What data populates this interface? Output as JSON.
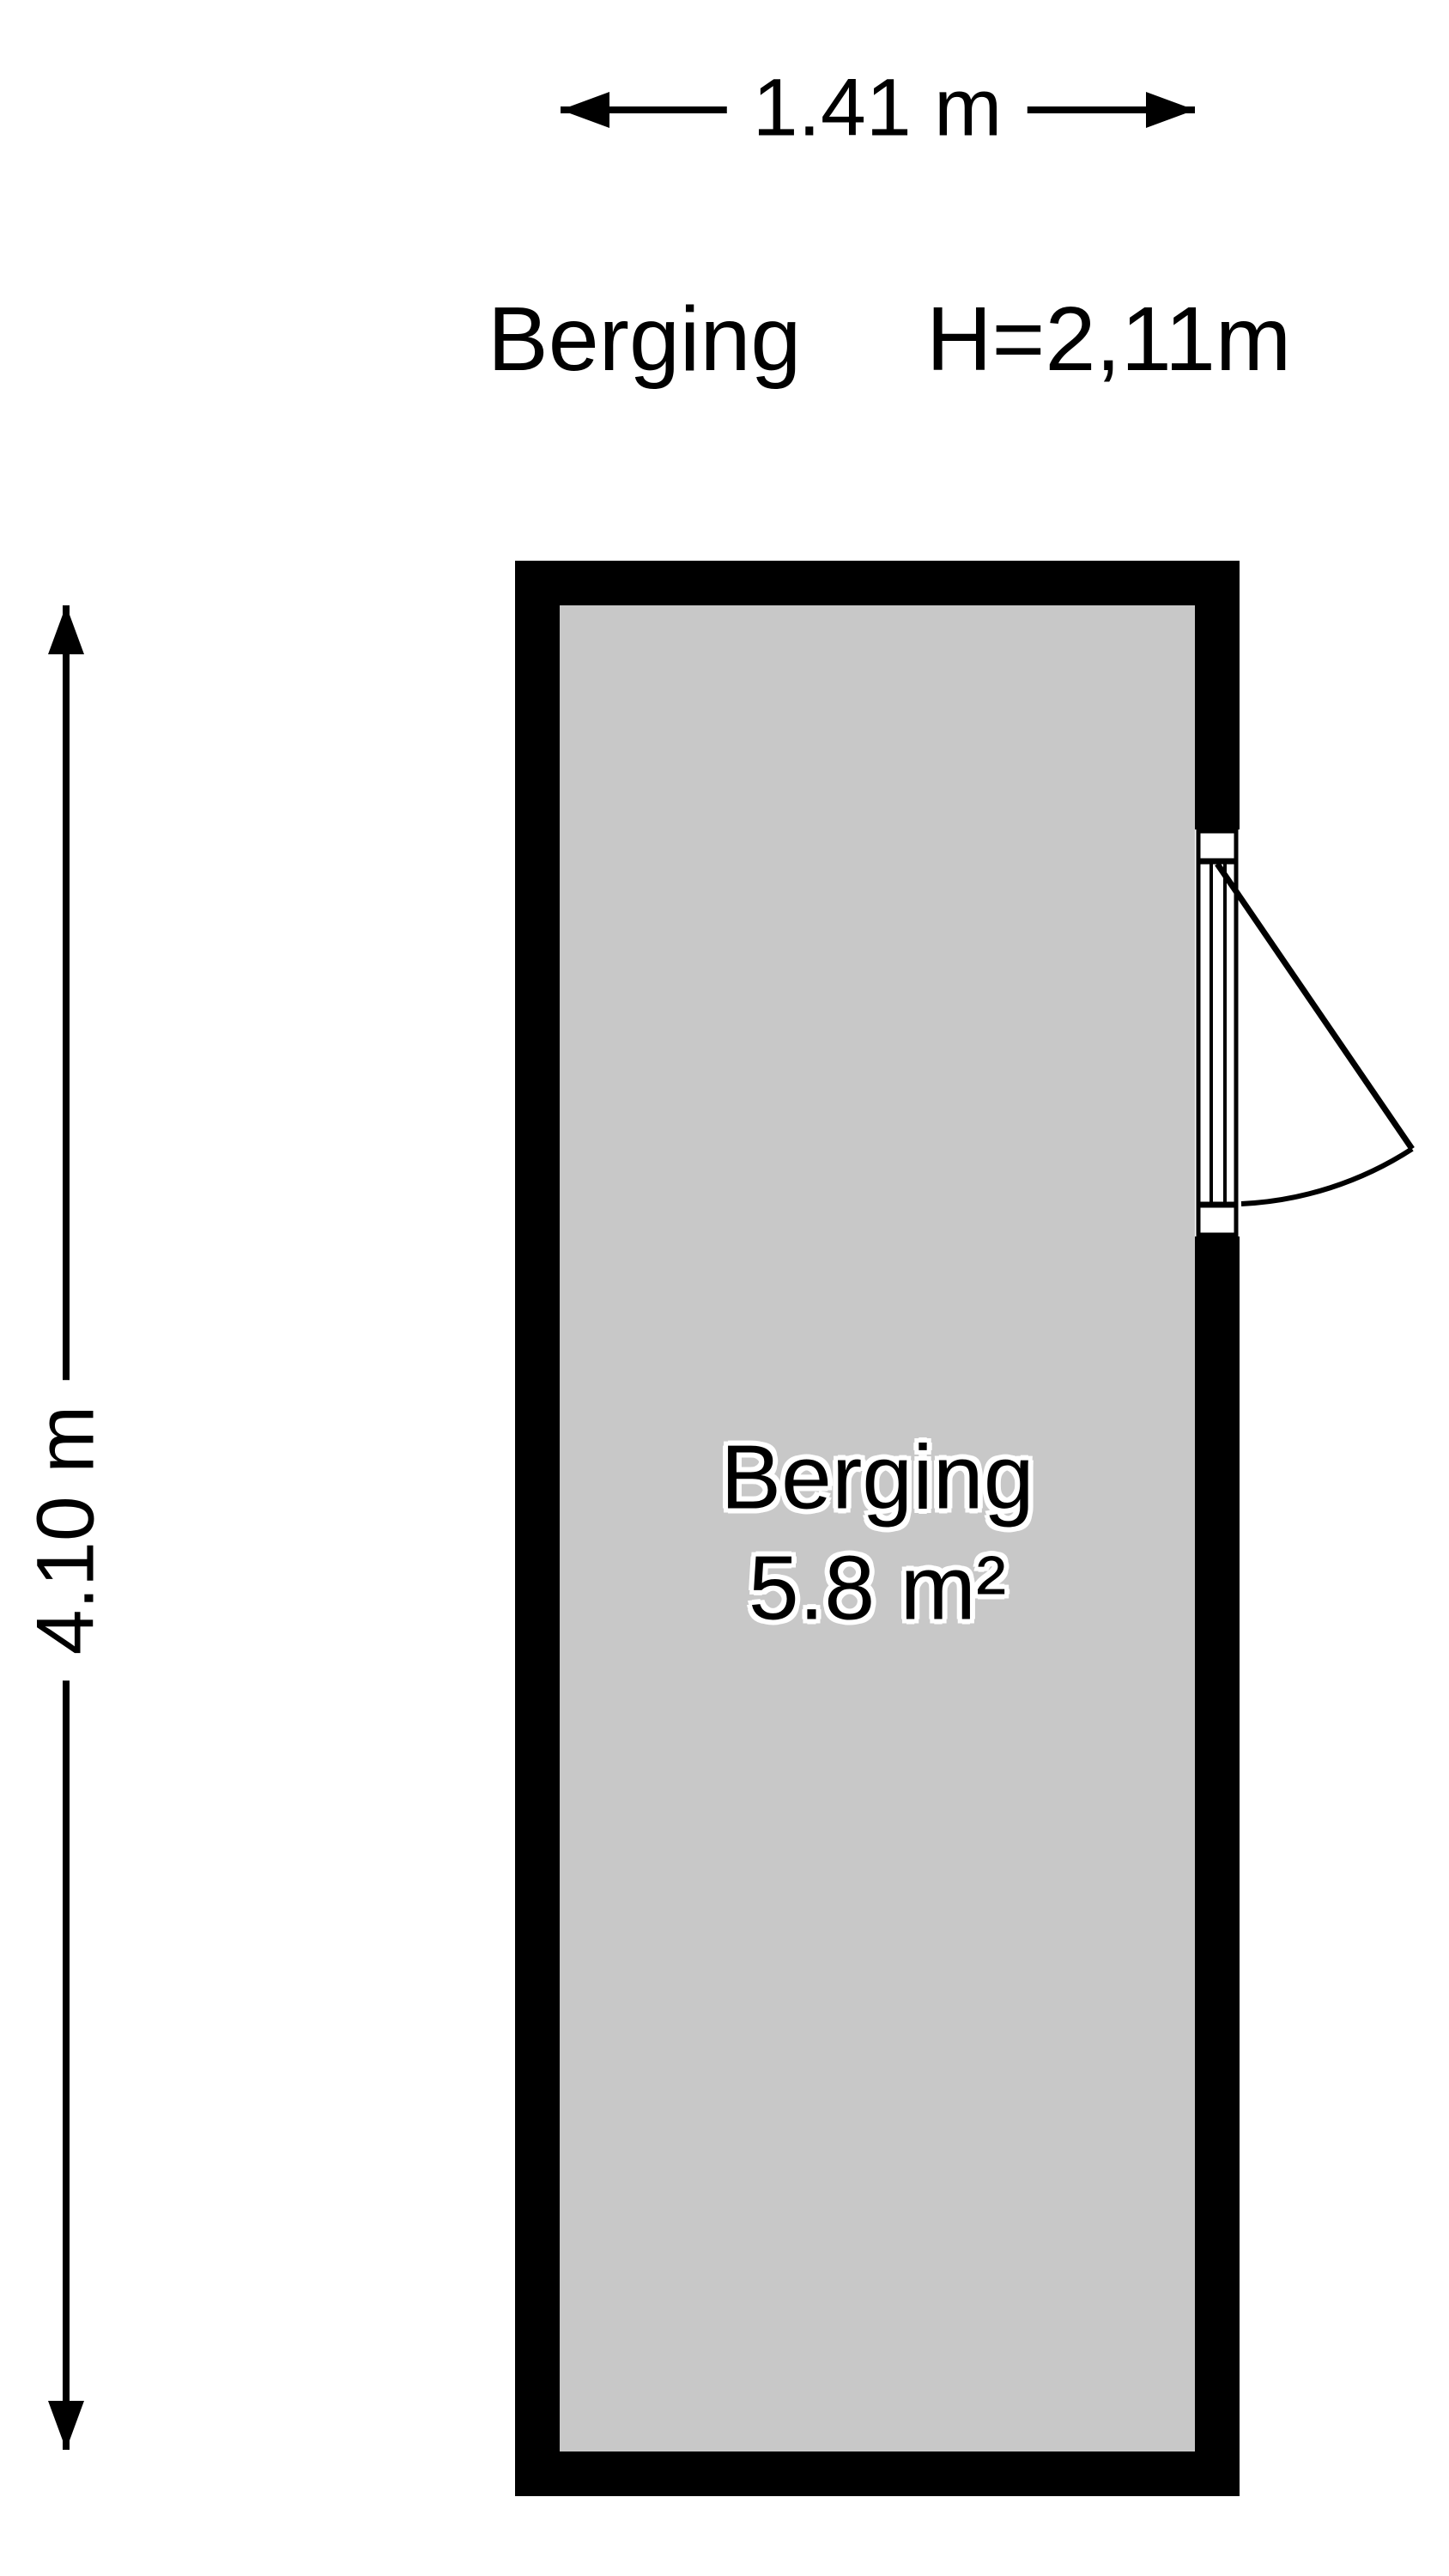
{
  "header": {
    "room_name": "Berging",
    "ceiling_height": "H=2,11m"
  },
  "dimensions": {
    "width_label": "1.41 m",
    "height_label": "4.10 m"
  },
  "room": {
    "name": "Berging",
    "area": "5.8 m²"
  },
  "colors": {
    "wall": "#000000",
    "floor": "#C8C8C8",
    "background": "#FFFFFF",
    "text": "#000000",
    "label_outline": "#FFFFFF"
  }
}
